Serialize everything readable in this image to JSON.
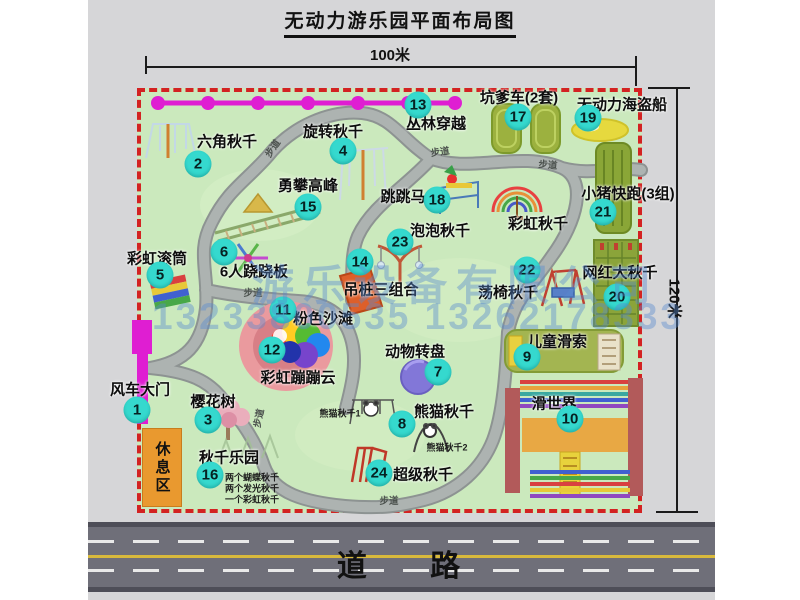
{
  "title": "无动力游乐园平面布局图",
  "dimensions": {
    "width_label": "100米",
    "height_label": "120米"
  },
  "road": {
    "label": "道    路"
  },
  "rest_area": {
    "label": "休息区"
  },
  "watermark": {
    "company": "游乐设备有限公司",
    "phone": "13233800535 13262178333"
  },
  "path_label_text": "步道",
  "rainbow_swing_label": "彩虹秋千",
  "colors": {
    "park_green": "#cbe9bd",
    "border_red": "#d32222",
    "badge_cyan": "#35d9ce",
    "magenta": "#df1ed2",
    "road_gray": "#6f6f79",
    "olive_green": "#93a93c",
    "rest_orange": "#e9992f",
    "watermark_blue": "#588ad0"
  },
  "attractions": [
    {
      "num": "1",
      "label": "风车大门",
      "badge": [
        137,
        410
      ],
      "label_pos": [
        140,
        389
      ]
    },
    {
      "num": "2",
      "label": "六角秋千",
      "badge": [
        198,
        164
      ],
      "label_pos": [
        227,
        141
      ]
    },
    {
      "num": "3",
      "label": "樱花树",
      "badge": [
        208,
        420
      ],
      "label_pos": [
        213,
        401
      ]
    },
    {
      "num": "4",
      "label": "旋转秋千",
      "badge": [
        343,
        151
      ],
      "label_pos": [
        333,
        131
      ]
    },
    {
      "num": "5",
      "label": "彩虹滚筒",
      "badge": [
        160,
        275
      ],
      "label_pos": [
        157,
        258
      ]
    },
    {
      "num": "6",
      "label": "6人跷跷板",
      "badge": [
        224,
        252
      ],
      "label_pos": [
        254,
        271
      ]
    },
    {
      "num": "7",
      "label": "动物转盘",
      "badge": [
        438,
        372
      ],
      "label_pos": [
        415,
        351
      ]
    },
    {
      "num": "8",
      "label": "熊猫秋千",
      "badge": [
        402,
        424
      ],
      "label_pos": [
        444,
        411
      ]
    },
    {
      "num": "9",
      "label": "儿童滑索",
      "badge": [
        527,
        357
      ],
      "label_pos": [
        557,
        341
      ]
    },
    {
      "num": "10",
      "label": "滑世界",
      "badge": [
        570,
        419
      ],
      "label_pos": [
        554,
        403
      ]
    },
    {
      "num": "11",
      "label": "粉色沙滩",
      "badge": [
        283,
        310
      ],
      "label_pos": [
        323,
        318
      ]
    },
    {
      "num": "12",
      "label": "彩虹蹦蹦云",
      "badge": [
        272,
        350
      ],
      "label_pos": [
        298,
        377
      ]
    },
    {
      "num": "13",
      "label": "丛林穿越",
      "badge": [
        418,
        105
      ],
      "label_pos": [
        436,
        123
      ]
    },
    {
      "num": "14",
      "label": "吊桩三组合",
      "badge": [
        360,
        262
      ],
      "label_pos": [
        381,
        289
      ]
    },
    {
      "num": "15",
      "label": "勇攀高峰",
      "badge": [
        308,
        207
      ],
      "label_pos": [
        308,
        185
      ]
    },
    {
      "num": "16",
      "label": "秋千乐园",
      "badge": [
        210,
        475
      ],
      "label_pos": [
        229,
        457
      ]
    },
    {
      "num": "17",
      "label": "坑爹车(2套)",
      "badge": [
        518,
        117
      ],
      "label_pos": [
        519,
        97
      ]
    },
    {
      "num": "18",
      "label": "跳跳马",
      "badge": [
        437,
        200
      ],
      "label_pos": [
        403,
        196
      ]
    },
    {
      "num": "19",
      "label": "无动力海盗船",
      "badge": [
        588,
        118
      ],
      "label_pos": [
        622,
        104
      ]
    },
    {
      "num": "20",
      "label": "网红大秋千",
      "badge": [
        617,
        297
      ],
      "label_pos": [
        620,
        272
      ]
    },
    {
      "num": "21",
      "label": "小猪快跑(3组)",
      "badge": [
        603,
        212
      ],
      "label_pos": [
        628,
        193
      ]
    },
    {
      "num": "22",
      "label": "荡椅秋千",
      "badge": [
        527,
        270
      ],
      "label_pos": [
        508,
        292
      ]
    },
    {
      "num": "23",
      "label": "泡泡秋千",
      "badge": [
        400,
        242
      ],
      "label_pos": [
        440,
        230
      ]
    },
    {
      "num": "24",
      "label": "超级秋千",
      "badge": [
        379,
        473
      ],
      "label_pos": [
        423,
        474
      ]
    }
  ],
  "path_labels": [
    {
      "x": 272,
      "y": 148,
      "r": -55
    },
    {
      "x": 440,
      "y": 151,
      "r": -8
    },
    {
      "x": 548,
      "y": 164,
      "r": 5
    },
    {
      "x": 253,
      "y": 292,
      "r": 0
    },
    {
      "x": 258,
      "y": 418,
      "r": -78
    },
    {
      "x": 389,
      "y": 500,
      "r": 0
    }
  ],
  "sub_labels": [
    {
      "text": "熊猫秋千1",
      "x": 340,
      "y": 413
    },
    {
      "text": "熊猫秋千2",
      "x": 447,
      "y": 447
    },
    {
      "text": "两个蝴蝶秋千",
      "x": 252,
      "y": 477
    },
    {
      "text": "两个发光秋千",
      "x": 252,
      "y": 488
    },
    {
      "text": "一个彩虹秋千",
      "x": 252,
      "y": 499
    }
  ]
}
